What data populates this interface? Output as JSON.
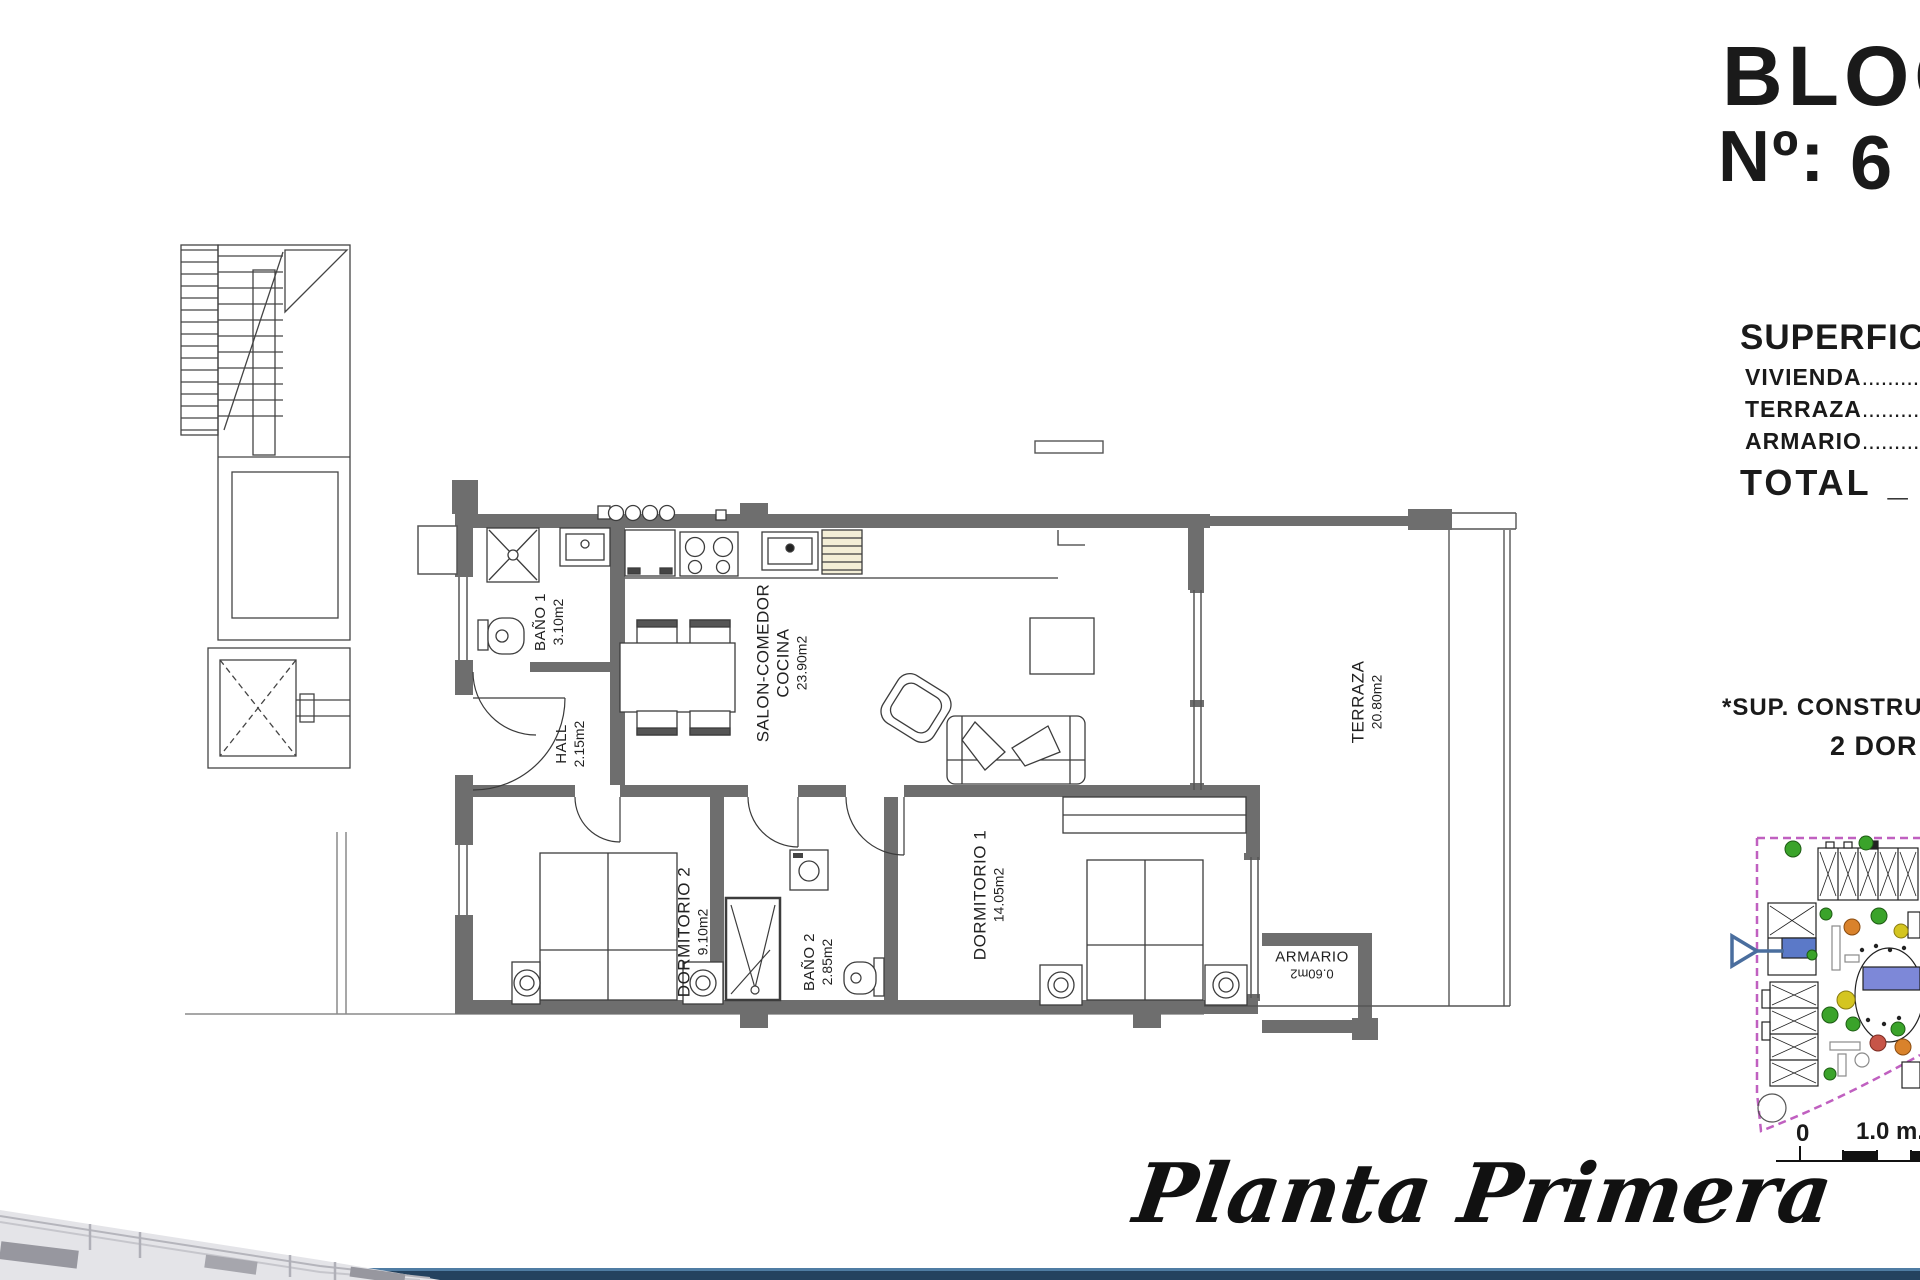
{
  "header": {
    "bloc": "BLOC",
    "numero_label": "Nº:",
    "numero_value": "6",
    "superficie_title": "SUPERFICIE",
    "rows": [
      {
        "label": "VIVIENDA",
        "dots": ".................................."
      },
      {
        "label": "TERRAZA",
        "dots": ".................................."
      },
      {
        "label": "ARMARIO",
        "dots": ".................................."
      }
    ],
    "total_label": "TOTAL",
    "total_separator": "_",
    "total_value": "8",
    "footnote": "*SUP. CONSTRUIDAS",
    "type_line": "2 DOR"
  },
  "plan": {
    "rooms": [
      {
        "name": "BAÑO 1",
        "area": "3.10m2"
      },
      {
        "name": "HALL",
        "area": "2.15m2"
      },
      {
        "name": "SALON-COMEDOR",
        "name2": "COCINA",
        "area": "23.90m2"
      },
      {
        "name": "DORMITORIO 2",
        "area": "9.10m2"
      },
      {
        "name": "BAÑO 2",
        "area": "2.85m2"
      },
      {
        "name": "DORMITORIO 1",
        "area": "14.05m2"
      },
      {
        "name": "ARMARIO",
        "area": "0.60m2"
      },
      {
        "name": "TERRAZA",
        "area": "20.80m2"
      }
    ]
  },
  "caption": "Planta Primera",
  "scale_bar": {
    "zero": "0",
    "unit": "1.0 m."
  },
  "colors": {
    "wall_gray": "#6e6e6e",
    "boundary_magenta": "#c060c0",
    "highlight_blue": "#5b79c8",
    "pool_blue": "#7d88d8",
    "arrow_blue": "#4a6e9e",
    "footer_band_blue": "#24425f"
  }
}
